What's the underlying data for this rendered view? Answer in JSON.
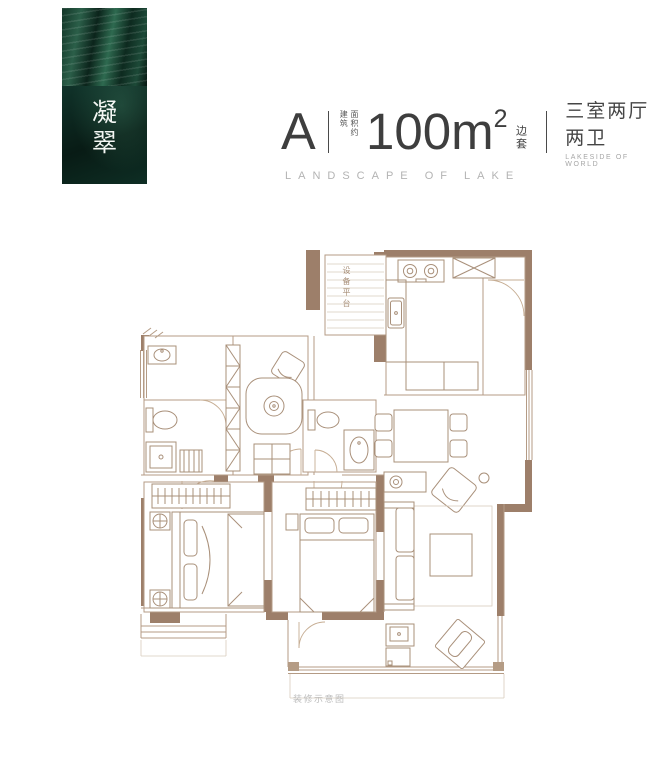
{
  "banner": {
    "chars": [
      "凝",
      "翠"
    ]
  },
  "header": {
    "plan_letter": "A",
    "area_note_left": "建筑",
    "area_note_right": "面积约",
    "area_value": "100m",
    "area_exponent": "2",
    "area_tag": "边套",
    "rooms": "三室两厅两卫",
    "rooms_sub": "LAKESIDE OF WORLD",
    "tagline": "LANDSCAPE OF LAKE"
  },
  "floorplan": {
    "equipment_platform": "设备平台",
    "caption": "装修示意图"
  },
  "colors": {
    "wall_fill": "#9d7f6a",
    "plan_line": "#b49b85",
    "banner_green": "#123527",
    "banner_green_deep": "#0a1f18",
    "title_text": "#3e3e3e",
    "muted_text": "#b3b3b3"
  }
}
